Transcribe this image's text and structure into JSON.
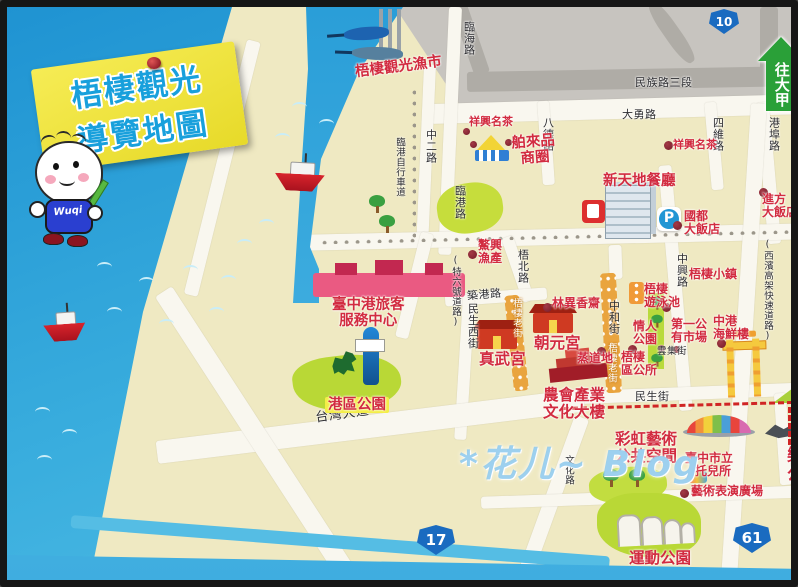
{
  "title": {
    "line1": "梧棲觀光",
    "line2": "導覽地圖"
  },
  "mascot": {
    "label": "Wuqi"
  },
  "direction_arrow": {
    "label": "往大甲"
  },
  "shields": {
    "n10": "10",
    "w17": "17",
    "e61": "61"
  },
  "watermark": "*花儿~ Blog",
  "roads": {
    "minzu": "民族路三段",
    "dayong": "大勇路",
    "linhai": "臨海路",
    "zhong2": "中二路",
    "bike_path": "臨港自行車道",
    "lingang": "臨港路",
    "bade": "八德路",
    "siwei": "四維路",
    "gangbu": "港埠路",
    "zhongxing": "中興路",
    "te6": "(特六號道路)",
    "wubei": "梧北路",
    "zhugang": "築港路",
    "minsheng_w": "民生西街",
    "zhonghe": "中和街",
    "old_street": "梧棲老街",
    "minsheng": "民生街",
    "taiwan_blvd": "台灣大道",
    "yunji": "雲集街",
    "wenhua": "文化路",
    "xibin": "(西濱高架快速道路)"
  },
  "pois": {
    "fish_market": "梧棲觀光漁市",
    "xiangxing_tea": "祥興名茶",
    "bolai": {
      "line1": "舶來品",
      "line2": "商圈"
    },
    "xintiandi": "新天地餐廳",
    "guodu": {
      "line1": "國都",
      "line2": "大飯店"
    },
    "jinfang": {
      "line1": "進方",
      "line2": "大飯店"
    },
    "wuqi_town": "梧棲小鎮",
    "aoxing": {
      "line1": "鰲興",
      "line2": "漁產"
    },
    "passenger_center": {
      "line1": "臺中港旅客",
      "line2": "服務中心"
    },
    "harbor_park": "港區公園",
    "zhenwu": "真武宮",
    "chaoyuan": "朝元宮",
    "linyixiang": "林異香齋",
    "nonghui": {
      "line1": "農會產業",
      "line2": "文化大樓"
    },
    "zhengdaodi": "蒸道地",
    "district_office": {
      "line1": "梧棲",
      "line2": "區公所"
    },
    "lovers_park": {
      "line1": "情人",
      "line2": "公園"
    },
    "pool": {
      "line1": "梧棲",
      "line2": "遊泳池"
    },
    "first_market": {
      "line1": "第一公",
      "line2": "有市場"
    },
    "seafood": {
      "line1": "中港",
      "line2": "海鮮樓"
    },
    "rainbow_art": {
      "line1": "彩虹藝術",
      "line2": "公共空間"
    },
    "nursery": {
      "line1": "臺中市立",
      "line2": "托兒所"
    },
    "art_plaza": "藝術表演廣場",
    "sports_park": "運動公園",
    "le_park": {
      "line1": "樂",
      "line2": "公"
    },
    "parking": "P"
  }
}
